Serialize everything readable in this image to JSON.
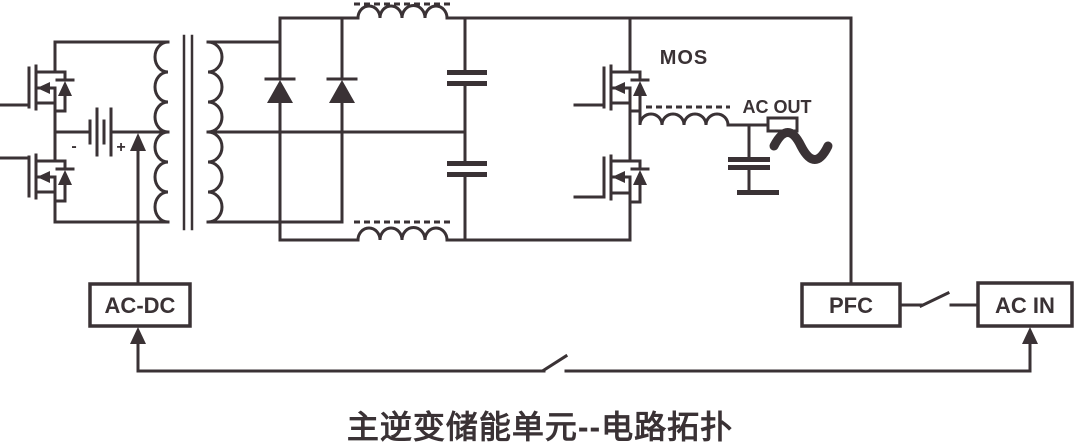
{
  "diagram": {
    "title": "主逆变储能单元--电路拓扑",
    "labels": {
      "mos": "MOS",
      "ac_out": "AC OUT",
      "battery_minus": "-",
      "battery_plus": "+"
    },
    "blocks": {
      "ac_dc": "AC-DC",
      "pfc": "PFC",
      "ac_in": "AC IN"
    },
    "colors": {
      "line": "#3a3235",
      "background": "#ffffff"
    }
  }
}
